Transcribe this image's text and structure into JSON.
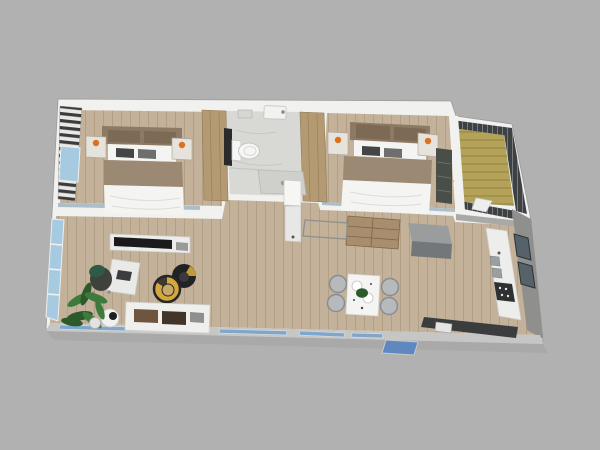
{
  "canvas": {
    "width": 600,
    "height": 450
  },
  "colors": {
    "background": "#b1b1b1",
    "shadow": "#a2a2a2",
    "wall_white": "#f1f1ef",
    "wall_light_gray": "#c6c6c4",
    "wall_cap_blue": "#9fb6c4",
    "kitchen_wall_gray": "#8f8f8d",
    "kitchen_top_wall": "#a9a9a7",
    "floor_wood": "#c3b199",
    "floor_bathroom": "#d8d8d4",
    "porch_deck": "#b3a258",
    "railing_dark": "#3d4144",
    "glass_blue": "#a6cbe0",
    "window_strip_blue": "#7fa6cb",
    "step_blue": "#5f88c0",
    "counter_white": "#ededeb",
    "counter_dark": "#3a3c3e",
    "stove_dark": "#2e3032",
    "appliance_gray": "#9aa0a2",
    "cabinet_gray": "#999d9e",
    "cabinet_gray_side": "#73777a",
    "wood_furniture": "#a98e6e",
    "wardrobe_tan": "#b49a72",
    "headboard_brown": "#8d7a64",
    "cushion_tan": "#7d6a55",
    "blanket_brown": "#9c8973",
    "bedding_white": "#f4f4f2",
    "media_dark": "#4a4e48",
    "sofa_white": "#efefed",
    "cushion_brown": "#6f5440",
    "cushion_dark": "#43342a",
    "chair_yellow": "#d4a83c",
    "chair_black": "#212225",
    "chair_gray": "#b6babc",
    "table_white": "#f4f4f2",
    "console_gray": "#ececea",
    "tv_black": "#1b1b1d",
    "side_gray": "#9a9a98",
    "window_dark": "#55626a",
    "plant_green": "#3e7a3b",
    "plant_green_dark": "#2c5a2b",
    "lamp_orange": "#d9731f",
    "desk_chair_green": "#2e5a46",
    "toilet_panel_dark": "#2b2b2b",
    "shower_gray": "#cfcfcb",
    "tile_white": "#f6f6f4"
  },
  "scene": {
    "type": "3d-floor-plan-render",
    "view": "isometric-top-down",
    "rooms": [
      {
        "name": "bedroom-1",
        "position": "top-left",
        "furniture": [
          "double-bed",
          "headboard-cushions",
          "nightstand-left",
          "nightstand-right",
          "table-lamps",
          "striped-window-blinds",
          "wardrobe-column"
        ]
      },
      {
        "name": "bathroom",
        "position": "top-center",
        "furniture": [
          "toilet",
          "dark-vanity-panel",
          "wall-sink",
          "soap-tray",
          "shower-pan"
        ]
      },
      {
        "name": "bedroom-2",
        "position": "top-right",
        "furniture": [
          "double-bed",
          "headboard-cushions",
          "nightstand-left",
          "nightstand-right",
          "table-lamps",
          "dark-media-unit",
          "wardrobe-column"
        ]
      },
      {
        "name": "porch",
        "position": "far-top-right",
        "furniture": [
          "wood-deck",
          "dark-slatted-railing",
          "white-deck-item",
          "small-plant"
        ]
      },
      {
        "name": "living-room",
        "position": "bottom-left",
        "furniture": [
          "white-sofa",
          "sofa-cushions",
          "tv-console",
          "tv",
          "desk",
          "office-chair",
          "yellow-tub-chair",
          "black-tub-chair",
          "round-side-table",
          "potted-plant",
          "glass-wall"
        ]
      },
      {
        "name": "dining-area",
        "position": "bottom-center",
        "furniture": [
          "white-dining-table",
          "four-gray-chairs",
          "plates",
          "green-centerpiece",
          "wood-dresser",
          "utility-column",
          "console-table",
          "entry-step"
        ]
      },
      {
        "name": "kitchen",
        "position": "bottom-right",
        "furniture": [
          "counter-with-sink",
          "stove",
          "island-cabinet",
          "dark-lower-counter",
          "dishwasher",
          "two-wall-windows"
        ]
      }
    ]
  }
}
